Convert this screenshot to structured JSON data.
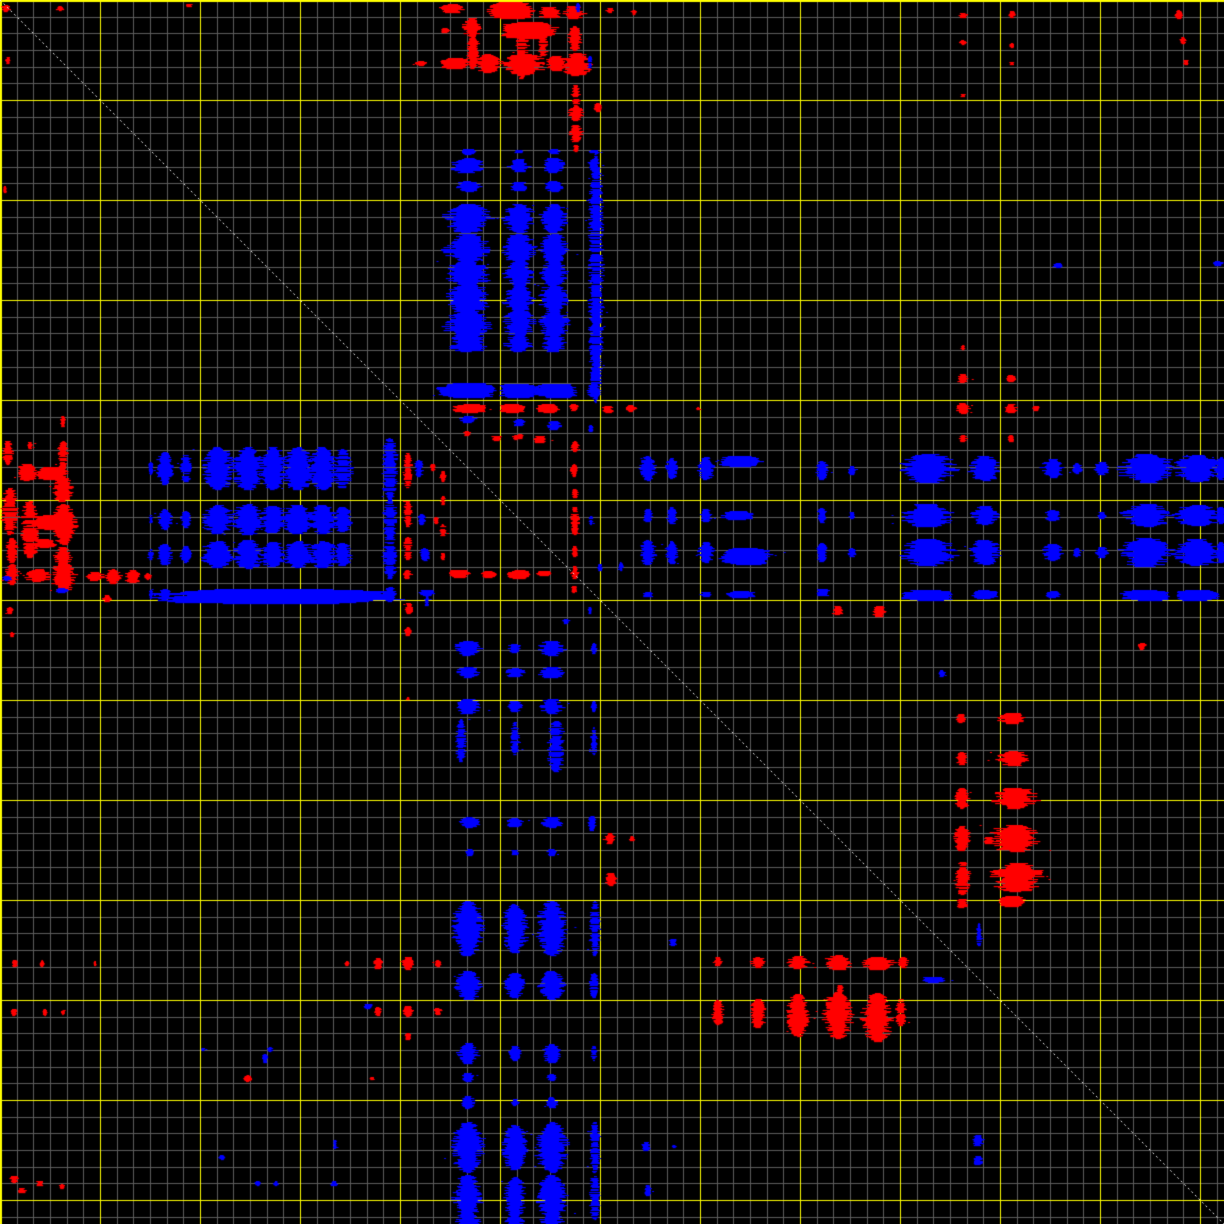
{
  "chart_data": {
    "type": "scatter",
    "subtype": "self-comparison-dotplot",
    "title": "",
    "xlabel": "",
    "ylabel": "",
    "size_px": 1224,
    "x_range_px": [
      0,
      1224
    ],
    "y_range_px": [
      0,
      1224
    ],
    "background": "#000000",
    "grid": {
      "major_step_px": 100,
      "minor_per_major": 6,
      "major_color": "#ffff00",
      "minor_color": "#5d5d5d",
      "grid_on": true
    },
    "diagonal": {
      "from": [
        0,
        0
      ],
      "to": [
        1224,
        1224
      ],
      "color": "#eeeeee",
      "dash": [
        2,
        3
      ]
    },
    "palette": [
      "#0000ff",
      "#ff0000"
    ],
    "legend_position": "none",
    "mirrored_about_diagonal": true,
    "blocks_format": "[cx, cy, w, h, colorIndex(0=blue,1=red), mirrorFlag]",
    "blocks": [
      [
        452,
        8,
        26,
        10,
        1,
        1
      ],
      [
        472,
        27,
        18,
        20,
        1,
        1
      ],
      [
        511,
        10,
        48,
        16,
        1,
        1
      ],
      [
        529,
        30,
        58,
        16,
        1,
        1
      ],
      [
        550,
        12,
        26,
        12,
        1,
        1
      ],
      [
        574,
        12,
        22,
        14,
        1,
        1
      ],
      [
        575,
        38,
        14,
        26,
        1,
        1
      ],
      [
        473,
        52,
        12,
        34,
        1,
        1
      ],
      [
        522,
        55,
        14,
        48,
        1,
        1
      ],
      [
        543,
        44,
        10,
        24,
        1,
        1
      ],
      [
        455,
        63,
        30,
        10,
        1,
        1
      ],
      [
        489,
        63,
        26,
        20,
        1,
        1
      ],
      [
        524,
        64,
        42,
        22,
        1,
        1
      ],
      [
        556,
        63,
        20,
        16,
        1,
        1
      ],
      [
        577,
        64,
        30,
        24,
        1,
        1
      ],
      [
        576,
        95,
        9,
        22,
        1,
        1
      ],
      [
        576,
        113,
        15,
        16,
        1,
        1
      ],
      [
        576,
        133,
        13,
        18,
        1,
        1
      ],
      [
        598,
        107,
        8,
        9,
        1,
        1
      ],
      [
        610,
        10,
        8,
        6,
        1,
        1
      ],
      [
        634,
        12,
        6,
        5,
        1,
        1
      ],
      [
        421,
        63,
        12,
        6,
        1,
        1
      ],
      [
        576,
        148,
        7,
        7,
        1,
        1
      ],
      [
        445,
        30,
        8,
        6,
        1,
        1
      ],
      [
        468,
        165,
        34,
        16,
        0,
        1
      ],
      [
        519,
        165,
        22,
        14,
        0,
        1
      ],
      [
        554,
        165,
        22,
        16,
        0,
        1
      ],
      [
        594,
        165,
        12,
        14,
        0,
        1
      ],
      [
        468,
        186,
        28,
        11,
        0,
        1
      ],
      [
        519,
        186,
        18,
        10,
        0,
        1
      ],
      [
        554,
        186,
        18,
        11,
        0,
        1
      ],
      [
        468,
        218,
        44,
        30,
        0,
        1
      ],
      [
        468,
        248,
        44,
        30,
        0,
        1
      ],
      [
        468,
        273,
        44,
        26,
        0,
        1
      ],
      [
        468,
        298,
        44,
        30,
        0,
        1
      ],
      [
        468,
        323,
        44,
        28,
        0,
        1
      ],
      [
        468,
        343,
        40,
        18,
        0,
        1
      ],
      [
        519,
        218,
        30,
        30,
        0,
        1
      ],
      [
        519,
        248,
        32,
        30,
        0,
        1
      ],
      [
        519,
        273,
        28,
        26,
        0,
        1
      ],
      [
        519,
        298,
        30,
        30,
        0,
        1
      ],
      [
        519,
        323,
        30,
        28,
        0,
        1
      ],
      [
        519,
        343,
        26,
        18,
        0,
        1
      ],
      [
        554,
        218,
        28,
        30,
        0,
        1
      ],
      [
        554,
        248,
        30,
        30,
        0,
        1
      ],
      [
        554,
        273,
        26,
        26,
        0,
        1
      ],
      [
        554,
        298,
        28,
        30,
        0,
        1
      ],
      [
        554,
        323,
        28,
        28,
        0,
        1
      ],
      [
        554,
        343,
        24,
        18,
        0,
        1
      ],
      [
        596,
        277,
        14,
        252,
        0,
        1
      ],
      [
        468,
        390,
        62,
        14,
        0,
        1
      ],
      [
        519,
        390,
        42,
        13,
        0,
        1
      ],
      [
        556,
        390,
        46,
        13,
        0,
        1
      ],
      [
        594,
        390,
        15,
        13,
        0,
        1
      ],
      [
        468,
        419,
        18,
        8,
        0,
        1
      ],
      [
        519,
        422,
        12,
        8,
        0,
        1
      ],
      [
        554,
        425,
        14,
        10,
        0,
        1
      ],
      [
        468,
        151,
        14,
        5,
        0,
        1
      ],
      [
        519,
        151,
        10,
        4,
        0,
        1
      ],
      [
        554,
        151,
        12,
        5,
        0,
        1
      ],
      [
        594,
        151,
        10,
        4,
        0,
        1
      ],
      [
        470,
        408,
        36,
        8,
        1,
        1
      ],
      [
        513,
        408,
        28,
        8,
        1,
        1
      ],
      [
        548,
        408,
        24,
        8,
        1,
        1
      ],
      [
        574,
        407,
        10,
        7,
        1,
        1
      ],
      [
        467,
        433,
        8,
        6,
        1,
        1
      ],
      [
        520,
        436,
        8,
        6,
        1,
        1
      ],
      [
        608,
        409,
        12,
        8,
        1,
        1
      ],
      [
        631,
        408,
        10,
        7,
        1,
        1
      ],
      [
        698,
        408,
        4,
        4,
        1,
        1
      ],
      [
        497,
        438,
        12,
        6,
        1,
        0
      ],
      [
        516,
        437,
        8,
        5,
        1,
        0
      ],
      [
        540,
        439,
        14,
        8,
        1,
        0
      ],
      [
        575,
        446,
        8,
        11,
        1,
        0
      ],
      [
        574,
        470,
        7,
        14,
        1,
        0
      ],
      [
        575,
        493,
        6,
        10,
        1,
        0
      ],
      [
        575,
        520,
        8,
        30,
        1,
        0
      ],
      [
        575,
        551,
        7,
        12,
        1,
        0
      ],
      [
        575,
        572,
        8,
        14,
        1,
        0
      ],
      [
        574,
        589,
        6,
        8,
        1,
        0
      ],
      [
        443,
        476,
        6,
        12,
        1,
        0
      ],
      [
        443,
        500,
        5,
        10,
        1,
        0
      ],
      [
        443,
        530,
        6,
        14,
        1,
        0
      ],
      [
        443,
        556,
        5,
        8,
        1,
        0
      ],
      [
        459,
        573,
        22,
        7,
        1,
        0
      ],
      [
        489,
        574,
        16,
        6,
        1,
        0
      ],
      [
        519,
        574,
        24,
        8,
        1,
        0
      ],
      [
        544,
        573,
        14,
        6,
        1,
        0
      ],
      [
        591,
        428,
        5,
        8,
        0,
        0
      ],
      [
        591,
        520,
        4,
        10,
        0,
        0
      ],
      [
        600,
        567,
        5,
        8,
        0,
        0
      ],
      [
        566,
        621,
        9,
        5,
        0,
        0
      ],
      [
        621,
        566,
        5,
        9,
        0,
        0
      ],
      [
        590,
        610,
        4,
        8,
        0,
        0
      ],
      [
        427,
        592,
        16,
        5,
        0,
        0
      ],
      [
        427,
        600,
        5,
        12,
        0,
        0
      ],
      [
        648,
        468,
        16,
        26,
        0,
        1
      ],
      [
        648,
        515,
        10,
        14,
        0,
        1
      ],
      [
        648,
        552,
        16,
        26,
        0,
        1
      ],
      [
        648,
        594,
        12,
        6,
        0,
        1
      ],
      [
        672,
        468,
        12,
        22,
        0,
        1
      ],
      [
        672,
        515,
        10,
        18,
        0,
        1
      ],
      [
        672,
        552,
        12,
        24,
        0,
        1
      ],
      [
        706,
        468,
        16,
        24,
        0,
        1
      ],
      [
        706,
        515,
        12,
        14,
        0,
        1
      ],
      [
        706,
        552,
        16,
        22,
        0,
        1
      ],
      [
        706,
        594,
        12,
        6,
        0,
        1
      ],
      [
        740,
        461,
        44,
        10,
        0,
        1
      ],
      [
        738,
        515,
        34,
        8,
        0,
        1
      ],
      [
        746,
        556,
        52,
        16,
        0,
        1
      ],
      [
        741,
        594,
        30,
        6,
        0,
        1
      ],
      [
        822,
        470,
        12,
        20,
        0,
        1
      ],
      [
        822,
        515,
        10,
        16,
        0,
        1
      ],
      [
        822,
        552,
        12,
        20,
        0,
        1
      ],
      [
        823,
        592,
        16,
        8,
        0,
        1
      ],
      [
        852,
        470,
        8,
        10,
        0,
        1
      ],
      [
        852,
        515,
        6,
        8,
        0,
        1
      ],
      [
        852,
        552,
        8,
        10,
        0,
        1
      ],
      [
        928,
        468,
        56,
        30,
        0,
        1
      ],
      [
        928,
        515,
        50,
        24,
        0,
        1
      ],
      [
        928,
        552,
        56,
        28,
        0,
        1
      ],
      [
        928,
        595,
        56,
        10,
        0,
        1
      ],
      [
        985,
        468,
        30,
        26,
        0,
        1
      ],
      [
        985,
        515,
        26,
        20,
        0,
        1
      ],
      [
        985,
        552,
        30,
        26,
        0,
        1
      ],
      [
        985,
        594,
        26,
        8,
        0,
        1
      ],
      [
        1053,
        468,
        22,
        20,
        0,
        1
      ],
      [
        1053,
        515,
        16,
        12,
        0,
        1
      ],
      [
        1053,
        552,
        20,
        18,
        0,
        1
      ],
      [
        1053,
        594,
        16,
        6,
        0,
        1
      ],
      [
        1077,
        468,
        10,
        12,
        0,
        1
      ],
      [
        1077,
        552,
        8,
        10,
        0,
        1
      ],
      [
        1102,
        468,
        14,
        14,
        0,
        1
      ],
      [
        1102,
        515,
        8,
        8,
        0,
        1
      ],
      [
        1102,
        552,
        12,
        12,
        0,
        1
      ],
      [
        1147,
        468,
        52,
        30,
        0,
        1
      ],
      [
        1147,
        515,
        46,
        24,
        0,
        1
      ],
      [
        1147,
        552,
        52,
        30,
        0,
        1
      ],
      [
        1147,
        595,
        52,
        10,
        0,
        1
      ],
      [
        1197,
        468,
        46,
        28,
        0,
        1
      ],
      [
        1197,
        515,
        42,
        22,
        0,
        1
      ],
      [
        1197,
        552,
        46,
        28,
        0,
        1
      ],
      [
        1197,
        595,
        46,
        10,
        0,
        1
      ],
      [
        1221,
        468,
        12,
        24,
        0,
        1
      ],
      [
        1221,
        515,
        10,
        18,
        0,
        1
      ],
      [
        1221,
        552,
        12,
        22,
        0,
        1
      ],
      [
        718,
        961,
        10,
        10,
        1,
        1
      ],
      [
        758,
        962,
        14,
        12,
        1,
        1
      ],
      [
        798,
        962,
        22,
        14,
        1,
        1
      ],
      [
        838,
        962,
        26,
        16,
        1,
        1
      ],
      [
        878,
        963,
        34,
        14,
        1,
        1
      ],
      [
        903,
        962,
        10,
        12,
        1,
        1
      ],
      [
        718,
        1012,
        12,
        26,
        1,
        1
      ],
      [
        758,
        1013,
        16,
        30,
        1,
        1
      ],
      [
        798,
        1015,
        22,
        44,
        1,
        1
      ],
      [
        838,
        1015,
        28,
        48,
        1,
        1
      ],
      [
        877,
        1017,
        30,
        50,
        1,
        1
      ],
      [
        901,
        1012,
        10,
        28,
        1,
        1
      ],
      [
        840,
        989,
        8,
        10,
        1,
        1
      ],
      [
        838,
        610,
        12,
        10,
        1,
        1
      ],
      [
        879,
        611,
        14,
        12,
        1,
        1
      ],
      [
        632,
        838,
        6,
        6,
        1,
        0
      ],
      [
        963,
        347,
        5,
        5,
        1,
        1
      ],
      [
        963,
        378,
        12,
        10,
        1,
        1
      ],
      [
        1011,
        378,
        9,
        8,
        1,
        1
      ],
      [
        963,
        408,
        14,
        12,
        1,
        1
      ],
      [
        1011,
        408,
        12,
        10,
        1,
        1
      ],
      [
        1036,
        408,
        8,
        6,
        1,
        1
      ],
      [
        963,
        438,
        8,
        8,
        1,
        1
      ],
      [
        1011,
        438,
        8,
        8,
        1,
        1
      ],
      [
        6,
        8,
        10,
        8,
        1,
        0
      ],
      [
        60,
        8,
        8,
        5,
        1,
        1
      ],
      [
        189,
        5,
        8,
        4,
        1,
        1
      ],
      [
        1179,
        14,
        8,
        9,
        1,
        1
      ],
      [
        1183,
        40,
        6,
        8,
        1,
        1
      ],
      [
        1186,
        62,
        6,
        6,
        1,
        1
      ],
      [
        963,
        15,
        8,
        6,
        1,
        1
      ],
      [
        963,
        42,
        7,
        5,
        1,
        1
      ],
      [
        1012,
        14,
        8,
        7,
        1,
        1
      ],
      [
        1012,
        45,
        7,
        5,
        1,
        1
      ],
      [
        1012,
        63,
        5,
        4,
        1,
        1
      ],
      [
        963,
        95,
        5,
        4,
        1,
        1
      ],
      [
        22,
        1190,
        8,
        6,
        1,
        0
      ],
      [
        1142,
        646,
        9,
        7,
        1,
        0
      ],
      [
        248,
        1078,
        8,
        8,
        1,
        0
      ],
      [
        372,
        1078,
        4,
        4,
        1,
        0
      ],
      [
        673,
        942,
        8,
        8,
        0,
        1
      ],
      [
        934,
        979,
        24,
        5,
        0,
        1
      ],
      [
        978,
        1140,
        12,
        12,
        0,
        0
      ],
      [
        978,
        1160,
        10,
        10,
        0,
        0
      ],
      [
        1058,
        265,
        10,
        6,
        0,
        1
      ],
      [
        1218,
        263,
        10,
        6,
        0,
        0
      ],
      [
        578,
        7,
        5,
        10,
        0,
        1
      ],
      [
        368,
        1006,
        12,
        5,
        0,
        0
      ],
      [
        590,
        62,
        4,
        14,
        0,
        1
      ],
      [
        646,
        1146,
        8,
        10,
        0,
        0
      ],
      [
        648,
        1190,
        8,
        12,
        0,
        0
      ],
      [
        674,
        1146,
        5,
        4,
        0,
        0
      ],
      [
        203,
        1049,
        5,
        4,
        0,
        0
      ],
      [
        270,
        1049,
        6,
        5,
        0,
        0
      ],
      [
        222,
        1157,
        6,
        5,
        0,
        0
      ],
      [
        258,
        1183,
        7,
        5,
        0,
        0
      ],
      [
        276,
        1183,
        6,
        5,
        0,
        0
      ],
      [
        335,
        1144,
        4,
        10,
        0,
        0
      ],
      [
        334,
        1183,
        8,
        6,
        0,
        0
      ]
    ]
  }
}
